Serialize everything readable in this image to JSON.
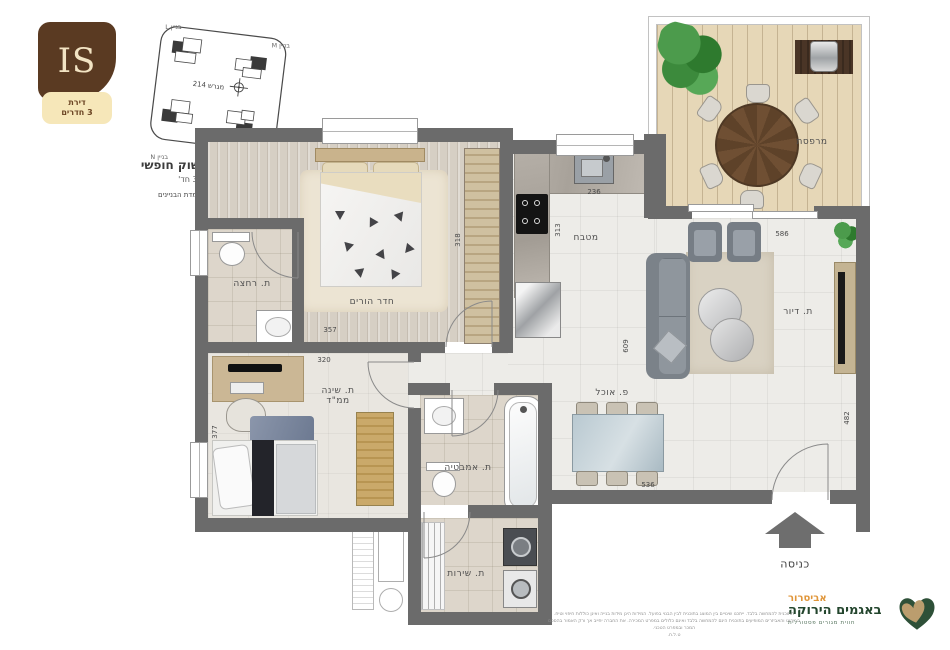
{
  "brand": {
    "logo_text": "IS",
    "badge_line1": "דירת",
    "badge_line2": "3 חדרים"
  },
  "siteplan": {
    "building_l": "בניין L",
    "building_m": "בניין M",
    "building_n": "בניין N",
    "building_o": "בניין O",
    "lot_label": "מגרש 214"
  },
  "header": {
    "title": "אשקלון 214 | שוק חופשי",
    "subtitle": "דגם IS | דירת 3 חד'",
    "note": "*חץ הצפון מתייחס להעמדת הבניינים"
  },
  "rooms": {
    "balcony_label": "מרפסת",
    "kitchen_label": "מטבח",
    "master_label": "חדר הורים",
    "bath1_label": "ת. רחצה",
    "bedroom2_label_line1": "ת. שינה",
    "bedroom2_label_line2": "ממ\"ד",
    "bath2_label": "ת. אמבטיה",
    "service_label": "ת. שירות",
    "dining_label": "פ. אוכל",
    "living_label": "ת. דיור"
  },
  "dims": {
    "kitchen_w": "236",
    "kitchen_h": "313",
    "master_w": "357",
    "master_h": "318",
    "bedroom2_w": "320",
    "bedroom2_h": "377",
    "living_w": "586",
    "living_h": "609",
    "living_side": "482",
    "dining_w": "536"
  },
  "entrance_label": "כניסה",
  "footer": {
    "brand_name": "אביסרור",
    "project_name": "באגמים הירוקה",
    "tagline": "חווית מגורים פסטורלית",
    "disclaimer1": "התוכנית להמחשה בלבד. ייתכנו שינויים בין המוצג בתוכנית לבין הבנוי בפועל. המידות הינן מידות בנייה ואינן כוללות חיפוי וטיח.",
    "disclaimer2": "הריהוט והאביזרים המופיעים בתוכנית הינם להמחשה בלבד ואינם כלולים במפרט המכירה. את החברה יחייב אך ורק האמור בהסכם המכר ובמפרט הטכני.",
    "disclaimer3": "ט.ל.ח."
  }
}
